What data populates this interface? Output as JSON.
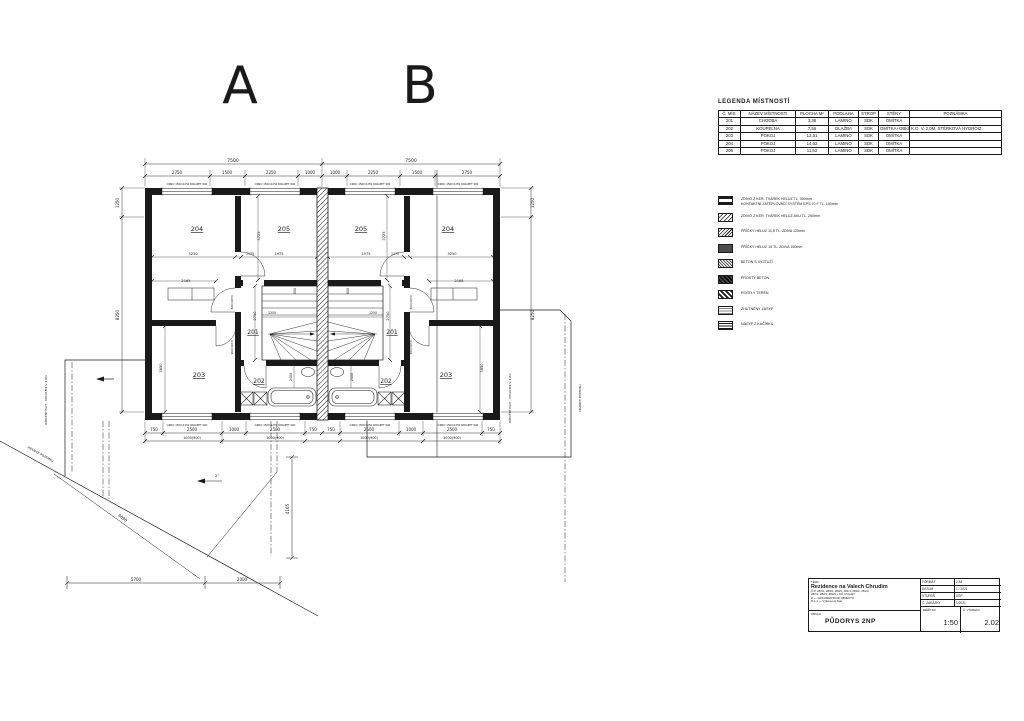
{
  "letters": {
    "unit_a": "A",
    "unit_b": "B"
  },
  "room_legend": {
    "title": "LEGENDA MÍSTNOSTÍ",
    "headers": [
      "Č. MÍS.",
      "NÁZEV MÍSTNOSTI",
      "PLOCHA M²",
      "PODLAHA",
      "STROP",
      "STĚNY",
      "POZNÁMKA"
    ],
    "rows": [
      [
        "201",
        "CHODBA",
        "3,38",
        "LAMINO",
        "SDK",
        "OMÍTKA",
        ""
      ],
      [
        "202",
        "KOUPELNA",
        "7,56",
        "DLAŽBA",
        "SDK",
        "OMÍTKA+OBKLAD",
        "K.O. V. 2,0M, STĚRKOVÁ HYDROIZ."
      ],
      [
        "203",
        "POKOJ",
        "13,51",
        "LAMINO",
        "SDK",
        "OMÍTKA",
        ""
      ],
      [
        "204",
        "POKOJ",
        "14,62",
        "LAMINO",
        "SDK",
        "OMÍTKA",
        ""
      ],
      [
        "205",
        "POKOJ",
        "11,52",
        "LAMINO",
        "SDK",
        "OMÍTKA",
        ""
      ]
    ]
  },
  "material_legend": {
    "items": [
      {
        "icon": "masonry-insulation-swatch",
        "label": "ZDIVO Z KER. TVÁREK HELUZ TL. 300mm",
        "label2": "KONTAKTNÍ ZATEPLOVACÍ SYSTÉM EPS 70 F TL. 150mm"
      },
      {
        "icon": "masonry-aku-swatch",
        "label": "ZDIVO Z KER. TVÁREK HELUZ AKU TL. 250mm",
        "label2": ""
      },
      {
        "icon": "partition-125-swatch",
        "label": "PŘÍČKY HELUZ 11,5 TL. ZDIVA 125mm",
        "label2": ""
      },
      {
        "icon": "partition-150-swatch",
        "label": "PŘÍČKY HELUZ 14 TL. ZDIVA 150mm",
        "label2": ""
      },
      {
        "icon": "reinforced-concrete-swatch",
        "label": "BETON S VÝZTUŽÍ",
        "label2": ""
      },
      {
        "icon": "plain-concrete-swatch",
        "label": "PROSTÝ BETON",
        "label2": ""
      },
      {
        "icon": "native-soil-swatch",
        "label": "ROSTLÝ TERÉN",
        "label2": ""
      },
      {
        "icon": "compacted-fill-swatch",
        "label": "ZHUTNĚNÝ ZÁSYP",
        "label2": ""
      },
      {
        "icon": "gravel-swatch",
        "label": "NÁSYP Z KAČÍRKU",
        "label2": ""
      }
    ]
  },
  "titleblock": {
    "tema_label": "TÉMA",
    "project": "Rezidence na Valech Chrudim",
    "parcels": "Č.P. 280/1, 280/2, 280/3, 281/1, 281/2, 281/3,",
    "parcels2": "282/1, 282/2, 282/3 + KÚ Chrudim",
    "doc_line1": "D — DOKUMENTACE OBJEKTŮ",
    "doc_line2": "D.1.1 — Výkresová část",
    "obsah_label": "OBSAH",
    "drawing_title": "PŮDORYS 2NP",
    "format_label": "FORMÁT",
    "format_value": "2 A4",
    "date_label": "DATUM",
    "date_value": "1 / 2021",
    "stage_label": "STUPEŇ",
    "stage_value": "DSP",
    "order_label": "Č. ZAKÁZKY",
    "order_value": "1/2021",
    "scale_label": "MĚŘÍTKO",
    "scale_value": "1:50",
    "dwg_label": "Č. VÝKRESU",
    "dwg_value": "2.02"
  },
  "plan": {
    "texts": [
      {
        "v": "A",
        "x": 240,
        "y": 103,
        "s": 52
      },
      {
        "v": "B",
        "x": 420,
        "y": 103,
        "s": 52
      },
      {
        "v": "7500",
        "x": 233,
        "y": 162,
        "s": 4.5
      },
      {
        "v": "7500",
        "x": 411,
        "y": 162,
        "s": 4.5
      },
      {
        "v": "2750",
        "x": 177,
        "y": 174,
        "s": 4
      },
      {
        "v": "1500",
        "x": 227,
        "y": 174,
        "s": 4
      },
      {
        "v": "2250",
        "x": 271,
        "y": 174,
        "s": 4
      },
      {
        "v": "1000",
        "x": 310,
        "y": 174,
        "s": 4
      },
      {
        "v": "1000",
        "x": 335,
        "y": 174,
        "s": 4
      },
      {
        "v": "2250",
        "x": 373,
        "y": 174,
        "s": 4
      },
      {
        "v": "1500",
        "x": 417,
        "y": 174,
        "s": 4
      },
      {
        "v": "2750",
        "x": 467,
        "y": 174,
        "s": 4
      },
      {
        "v": "750",
        "x": 154,
        "y": 431,
        "s": 4
      },
      {
        "v": "2500",
        "x": 192,
        "y": 431,
        "s": 4
      },
      {
        "v": "1000",
        "x": 234,
        "y": 431,
        "s": 4
      },
      {
        "v": "2500",
        "x": 275,
        "y": 431,
        "s": 4
      },
      {
        "v": "750",
        "x": 313,
        "y": 431,
        "s": 4
      },
      {
        "v": "750",
        "x": 331,
        "y": 431,
        "s": 4
      },
      {
        "v": "2500",
        "x": 369,
        "y": 431,
        "s": 4
      },
      {
        "v": "1000",
        "x": 411,
        "y": 431,
        "s": 4
      },
      {
        "v": "2500",
        "x": 452,
        "y": 431,
        "s": 4
      },
      {
        "v": "750",
        "x": 491,
        "y": 431,
        "s": 4
      },
      {
        "v": "1000(900)",
        "x": 192,
        "y": 439,
        "s": 3.4
      },
      {
        "v": "1000(900)",
        "x": 275,
        "y": 439,
        "s": 3.4
      },
      {
        "v": "1000(900)",
        "x": 369,
        "y": 439,
        "s": 3.4
      },
      {
        "v": "1000(900)",
        "x": 452,
        "y": 439,
        "s": 3.4
      },
      {
        "v": "1250",
        "x": 119,
        "y": 203,
        "s": 4,
        "r": -90
      },
      {
        "v": "8250",
        "x": 119,
        "y": 315,
        "s": 4,
        "r": -90
      },
      {
        "v": "1250",
        "x": 534,
        "y": 203,
        "s": 4,
        "r": -90
      },
      {
        "v": "8250",
        "x": 534,
        "y": 315,
        "s": 4,
        "r": -90
      },
      {
        "v": "204",
        "x": 197,
        "y": 231,
        "s": 6.5,
        "u": 1,
        "n": "room-label-204-a"
      },
      {
        "v": "205",
        "x": 284,
        "y": 231,
        "s": 6.5,
        "u": 1,
        "n": "room-label-205-a"
      },
      {
        "v": "201",
        "x": 253,
        "y": 334,
        "s": 6,
        "u": 1,
        "n": "room-label-201-a"
      },
      {
        "v": "202",
        "x": 259,
        "y": 383,
        "s": 6,
        "u": 1,
        "n": "room-label-202-a"
      },
      {
        "v": "203",
        "x": 199,
        "y": 377,
        "s": 6.5,
        "u": 1,
        "n": "room-label-203-a"
      },
      {
        "v": "205",
        "x": 361,
        "y": 231,
        "s": 6.5,
        "u": 1,
        "n": "room-label-205-b"
      },
      {
        "v": "204",
        "x": 448,
        "y": 231,
        "s": 6.5,
        "u": 1,
        "n": "room-label-204-b"
      },
      {
        "v": "201",
        "x": 392,
        "y": 334,
        "s": 6,
        "u": 1,
        "n": "room-label-201-b"
      },
      {
        "v": "202",
        "x": 386,
        "y": 383,
        "s": 6,
        "u": 1,
        "n": "room-label-202-b"
      },
      {
        "v": "203",
        "x": 446,
        "y": 377,
        "s": 6.5,
        "u": 1,
        "n": "room-label-203-b"
      },
      {
        "v": "3250",
        "x": 193,
        "y": 255,
        "s": 3.6
      },
      {
        "v": "1975",
        "x": 279,
        "y": 255,
        "s": 3.6
      },
      {
        "v": "1175",
        "x": 250,
        "y": 255,
        "s": 3.2
      },
      {
        "v": "2165",
        "x": 186,
        "y": 282,
        "s": 3.6
      },
      {
        "v": "3725",
        "x": 260,
        "y": 236,
        "s": 3.6,
        "r": -90
      },
      {
        "v": "2750",
        "x": 256,
        "y": 316,
        "s": 3.6,
        "r": -90
      },
      {
        "v": "1250",
        "x": 272,
        "y": 314,
        "s": 3.2
      },
      {
        "v": "800",
        "x": 296,
        "y": 291,
        "s": 3.2,
        "r": -90
      },
      {
        "v": "2400",
        "x": 292,
        "y": 377,
        "s": 3.2,
        "r": -90
      },
      {
        "v": "3850",
        "x": 162,
        "y": 368,
        "s": 3.6,
        "r": -90
      },
      {
        "v": "3250",
        "x": 452,
        "y": 255,
        "s": 3.6
      },
      {
        "v": "1975",
        "x": 366,
        "y": 255,
        "s": 3.6
      },
      {
        "v": "1175",
        "x": 395,
        "y": 255,
        "s": 3.2
      },
      {
        "v": "2165",
        "x": 459,
        "y": 282,
        "s": 3.6
      },
      {
        "v": "3725",
        "x": 385,
        "y": 236,
        "s": 3.6,
        "r": -90
      },
      {
        "v": "2750",
        "x": 389,
        "y": 316,
        "s": 3.6,
        "r": -90
      },
      {
        "v": "1250",
        "x": 373,
        "y": 314,
        "s": 3.2
      },
      {
        "v": "800",
        "x": 349,
        "y": 291,
        "s": 3.2,
        "r": -90
      },
      {
        "v": "2400",
        "x": 353,
        "y": 377,
        "s": 3.2,
        "r": -90
      },
      {
        "v": "3850",
        "x": 483,
        "y": 368,
        "s": 3.6,
        "r": -90
      },
      {
        "v": "800(1970)",
        "x": 233,
        "y": 302,
        "s": 2.8,
        "r": -90
      },
      {
        "v": "800(1970)",
        "x": 412,
        "y": 302,
        "s": 2.8,
        "r": -90
      },
      {
        "v": "900(1970)",
        "x": 233,
        "y": 347,
        "s": 2.8,
        "r": -90
      },
      {
        "v": "900(1970)",
        "x": 412,
        "y": 347,
        "s": 2.8,
        "r": -90
      },
      {
        "v": "OKNO 1500/1250 PARAPET 900",
        "x": 187,
        "y": 185,
        "s": 2.6
      },
      {
        "v": "OKNO 1500/1250 PARAPET 900",
        "x": 275,
        "y": 185,
        "s": 2.6
      },
      {
        "v": "OKNO 1500/1250 PARAPET 900",
        "x": 370,
        "y": 185,
        "s": 2.6
      },
      {
        "v": "OKNO 1500/1250 PARAPET 900",
        "x": 458,
        "y": 185,
        "s": 2.6
      },
      {
        "v": "OKNO 1500/1250 PARAPET 900",
        "x": 187,
        "y": 426,
        "s": 2.6
      },
      {
        "v": "OKNO 1500/1250 PARAPET 900",
        "x": 275,
        "y": 426,
        "s": 2.6
      },
      {
        "v": "OKNO 1500/1250 PARAPET 900",
        "x": 370,
        "y": 426,
        "s": 2.6
      },
      {
        "v": "OKNO 1500/1250 PARAPET 900",
        "x": 458,
        "y": 426,
        "s": 2.6
      },
      {
        "v": "5700",
        "x": 136,
        "y": 581,
        "s": 4
      },
      {
        "v": "2000",
        "x": 242,
        "y": 581,
        "s": 4
      },
      {
        "v": "4165",
        "x": 289,
        "y": 509,
        "s": 4,
        "r": -90
      },
      {
        "v": "6890",
        "x": 122,
        "y": 519,
        "s": 4,
        "r": 36
      },
      {
        "v": "2°",
        "x": 217,
        "y": 477,
        "s": 3.5
      },
      {
        "v": "HRANICE POZEMKU",
        "x": 40,
        "y": 455,
        "s": 3,
        "r": 29
      },
      {
        "v": "DŘEVĚNÝ PLOT - OPLOCENÍ V. 1,8m",
        "x": 47,
        "y": 400,
        "s": 2.8,
        "r": -90
      },
      {
        "v": "DŘEVĚNÝ PLOT - OPLOCENÍ V. 1,8m",
        "x": 511,
        "y": 398,
        "s": 2.8,
        "r": -90
      },
      {
        "v": "HRANICE POZEMKU",
        "x": 581,
        "y": 398,
        "s": 2.8,
        "r": -90
      }
    ]
  }
}
